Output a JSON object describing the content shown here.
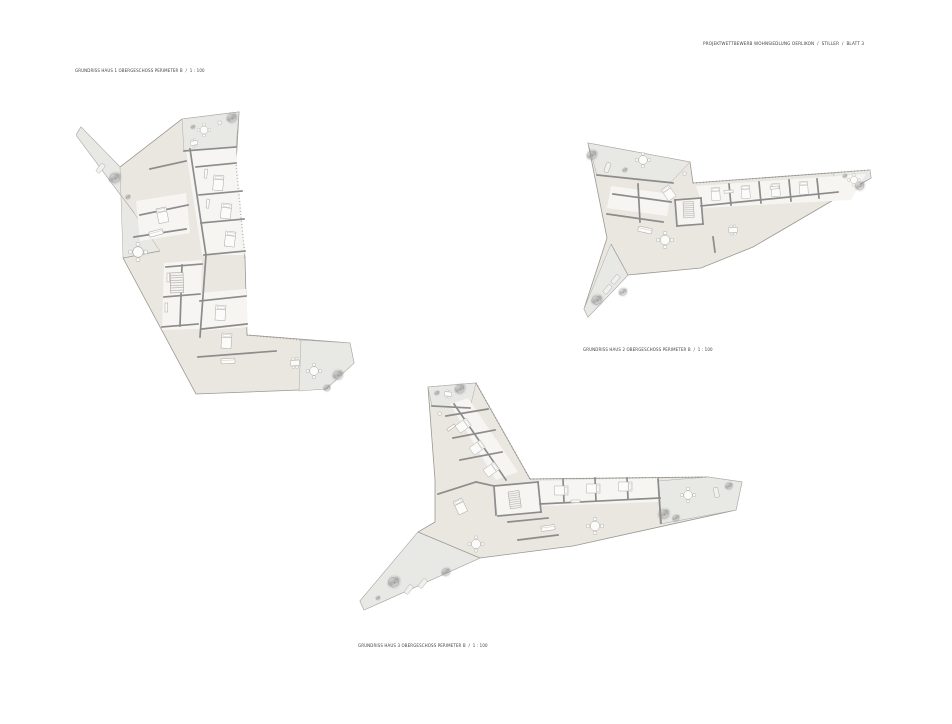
{
  "sheet": {
    "title": "PROJEKTWETTBEWERB WOHNSIEDLUNG OERLIKON  /  STILLER  /  BLATT 3",
    "background": "#ffffff"
  },
  "plans": [
    {
      "name": "Haus 1",
      "label": "GRUNDRISS HAUS 1 OBERGESCHOSS PERIMETER B  /  1 : 100"
    },
    {
      "name": "Haus 2",
      "label": "GRUNDRISS HAUS 2 OBERGESCHOSS PERIMETER B  /  1 : 100"
    },
    {
      "name": "Haus 3",
      "label": "GRUNDRISS HAUS 3 OBERGESCHOSS PERIMETER B  /  1 : 100"
    }
  ],
  "drawing_legend": {
    "floor_color": "#eae7e1",
    "room_color": "#f6f5f2",
    "terrace_color": "#e8e8e5",
    "wall_color": "#8c8c8c",
    "outline_color": "#9a9892",
    "furniture_stroke": "#a9a7a2",
    "tree_color": "#8f8f8f",
    "text_color": "#3f3f3f"
  }
}
